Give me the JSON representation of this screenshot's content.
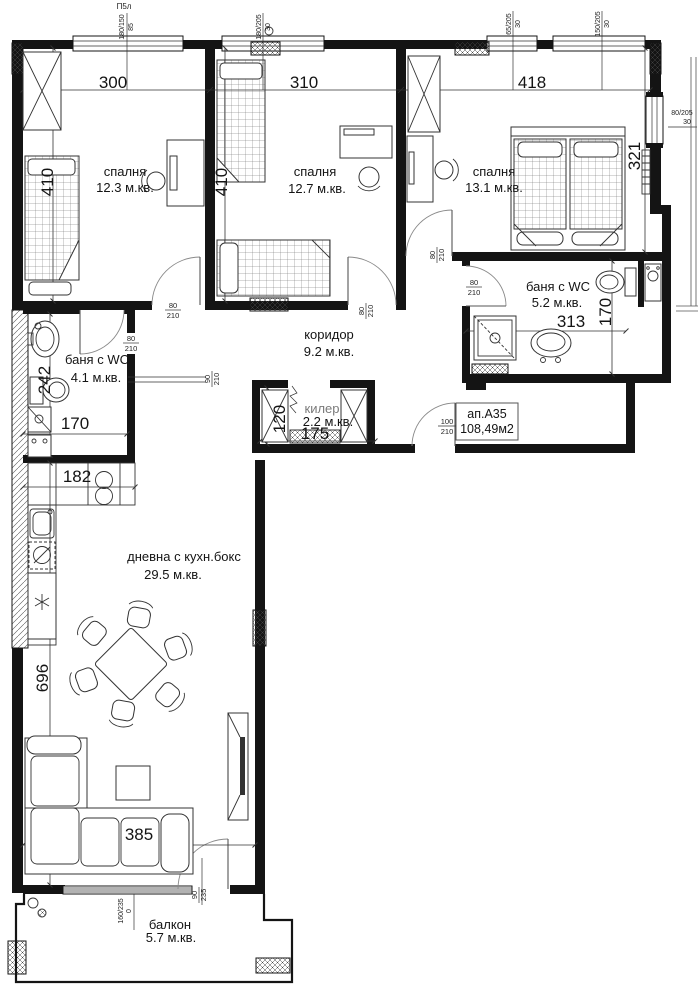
{
  "colors": {
    "wall": "#141414",
    "line": "#333333",
    "muted": "#7a7a7a",
    "paper": "#ffffff"
  },
  "plan_mark": "П5л",
  "apartment": {
    "id": "ап.А35",
    "area": "108,49м2"
  },
  "rooms": {
    "bedroom1": {
      "name": "спалня",
      "area": "12.3 м.кв."
    },
    "bedroom2": {
      "name": "спалня",
      "area": "12.7 м.кв."
    },
    "bedroom3": {
      "name": "спалня",
      "area": "13.1 м.кв."
    },
    "bath1": {
      "name": "баня с WC",
      "area": "4.1 м.кв."
    },
    "bath2": {
      "name": "баня с WC",
      "area": "5.2 м.кв."
    },
    "corridor": {
      "name": "коридор",
      "area": "9.2 м.кв."
    },
    "closet": {
      "name": "килер",
      "area": "2.2 м.кв."
    },
    "living": {
      "name": "дневна с кухн.бокс",
      "area": "29.5 м.кв."
    },
    "balcony": {
      "name": "балкон",
      "area": "5.7 м.кв."
    }
  },
  "dims": {
    "bedroom1_w": "300",
    "bedroom2_w": "310",
    "bedroom3_w": "418",
    "bedroom1_d": "410",
    "bedroom2_d": "410",
    "bedroom3_d": "321",
    "bath2_w": "313",
    "bath2_d": "170",
    "bath1_d": "242",
    "bath1_w": "170",
    "kitchen_w": "182",
    "closet_w": "175",
    "closet_d": "120",
    "living_d": "696",
    "living_w": "385"
  },
  "windows": {
    "w1": {
      "size": "180/150",
      "parapet": "85"
    },
    "w2": {
      "size": "180/205",
      "parapet": "30"
    },
    "w3": {
      "size": "65/205",
      "parapet": "30"
    },
    "w4": {
      "size": "150/205",
      "parapet": "30"
    },
    "w5": {
      "size": "80/205",
      "parapet": "30"
    },
    "balcony_w": {
      "size": "160/235",
      "parapet": "0"
    }
  },
  "doors": {
    "bedroom1": {
      "w": "80",
      "h": "210"
    },
    "bedroom2": {
      "w": "80",
      "h": "210"
    },
    "bedroom3": {
      "w": "80",
      "h": "210"
    },
    "bath1": {
      "w": "80",
      "h": "210"
    },
    "bath2": {
      "w": "80",
      "h": "210"
    },
    "entrance": {
      "w": "100",
      "h": "210"
    },
    "living_passage": {
      "w": "90",
      "h": "210"
    },
    "balcony": {
      "w": "90",
      "h": "235"
    }
  }
}
